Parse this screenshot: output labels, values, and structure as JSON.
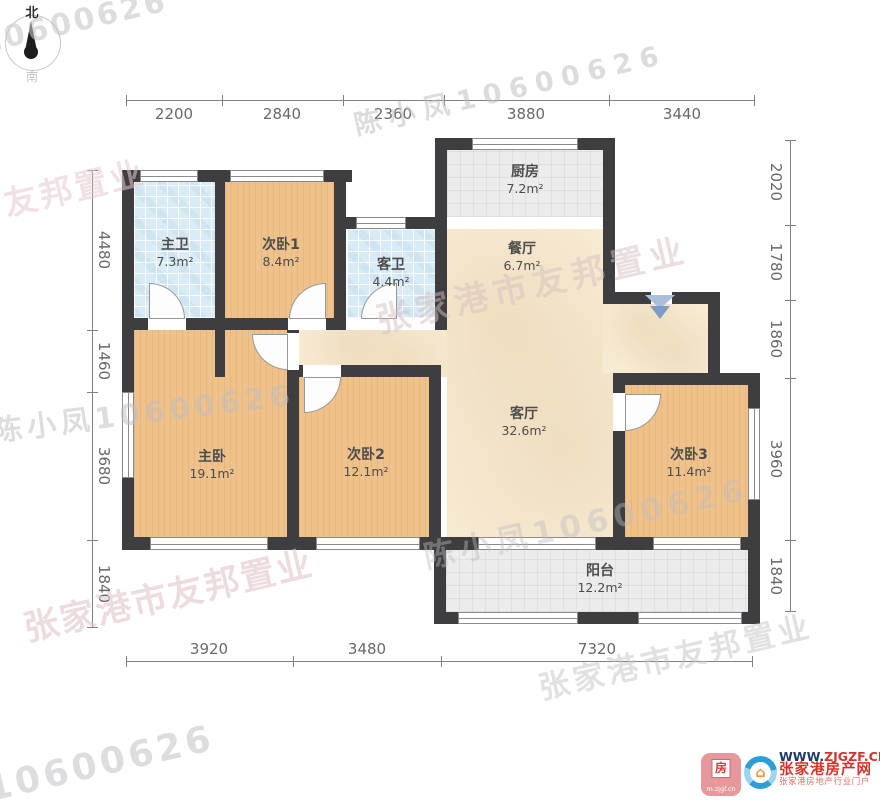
{
  "compass": {
    "north": "北",
    "south": "南"
  },
  "dimensions": {
    "top": [
      "2200",
      "2840",
      "2360",
      "3880",
      "3440"
    ],
    "bottom": [
      "3920",
      "3480",
      "7320"
    ],
    "left": [
      "4480",
      "1460",
      "3680",
      "1840"
    ],
    "right": [
      "2020",
      "1780",
      "1860",
      "3960",
      "1840"
    ]
  },
  "rooms": [
    {
      "name": "主卫",
      "area": "7.3m²"
    },
    {
      "name": "次卧1",
      "area": "8.4m²"
    },
    {
      "name": "客卫",
      "area": "4.4m²"
    },
    {
      "name": "厨房",
      "area": "7.2m²"
    },
    {
      "name": "餐厅",
      "area": "6.7m²"
    },
    {
      "name": "客厅",
      "area": "32.6m²"
    },
    {
      "name": "主卧",
      "area": "19.1m²"
    },
    {
      "name": "次卧2",
      "area": "12.1m²"
    },
    {
      "name": "次卧3",
      "area": "11.4m²"
    },
    {
      "name": "阳台",
      "area": "12.2m²"
    }
  ],
  "watermarks": {
    "company": "张家港市友邦置业",
    "agent": "陈小凤10600626"
  },
  "icons": {
    "house": "⌂"
  },
  "footer": {
    "app_icon_char": "房",
    "app_icon_url": "m.zjgf.cn",
    "site_url_prefix": "WWW.",
    "site_url": "ZJGZF.CN",
    "site_name": "张家港房产网",
    "site_tagline": "张家港房地产行业门户"
  },
  "colors": {
    "wall": "#3e3e40",
    "bedroom_floor": "#f0c28b",
    "bath_floor": "#d9ebf4",
    "kitchen_floor": "#ececec",
    "living_floor": "#f7ebd3",
    "entry_arrow": "#7e9cc8",
    "watermark_pink": "#dcc0c2",
    "watermark_gray": "#c3c3c7"
  }
}
